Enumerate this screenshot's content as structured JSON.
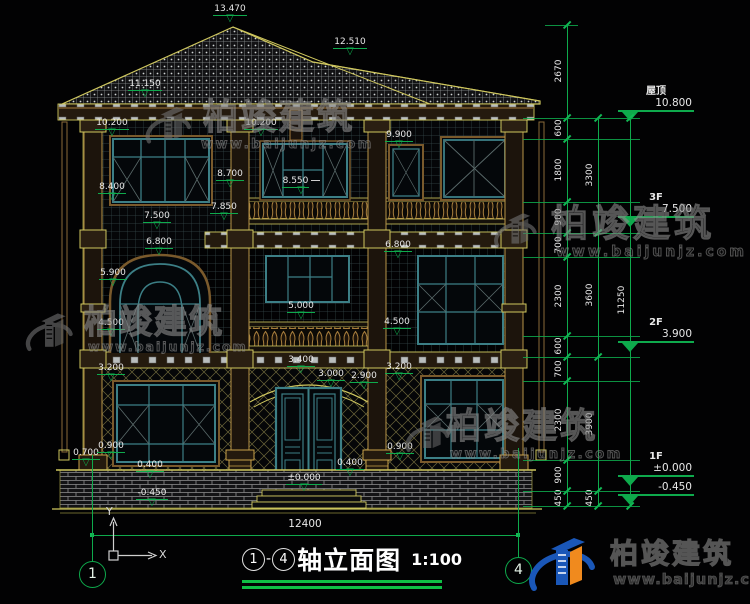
{
  "title_bar": {
    "axis_from": "1",
    "separator": "-",
    "axis_to": "4",
    "title": "轴立面图",
    "scale": "1:100"
  },
  "branding": {
    "brand": "柏竣建筑",
    "url": "www.baijunjz.com"
  },
  "watermark": {
    "brand": "柏竣建筑",
    "url": "www.baijunjz.com"
  },
  "ucs": {
    "x_label": "X",
    "y_label": "Y"
  },
  "overall_dim": {
    "label": "12400",
    "y": 535,
    "x1": 92,
    "x2": 518,
    "label_x": 275,
    "label_y": 518
  },
  "axis_bubbles": [
    {
      "num": "1",
      "cx": 92,
      "cy": 574,
      "stem_top": 455
    },
    {
      "num": "4",
      "cx": 518,
      "cy": 570,
      "stem_top": 448
    }
  ],
  "elevation_flags": [
    {
      "t": "13.470",
      "cx": 230,
      "y": 4
    },
    {
      "t": "12.510",
      "cx": 350,
      "y": 37
    },
    {
      "t": "11.150",
      "cx": 145,
      "y": 79
    },
    {
      "t": "10.200",
      "cx": 112,
      "y": 118
    },
    {
      "t": "10.200",
      "cx": 261,
      "y": 118
    },
    {
      "t": "9.900",
      "cx": 399,
      "y": 130
    },
    {
      "t": "8.700",
      "cx": 230,
      "y": 169
    },
    {
      "t": "8.550",
      "cx": 301,
      "y": 176,
      "dash": true
    },
    {
      "t": "8.400",
      "cx": 112,
      "y": 182
    },
    {
      "t": "7.850",
      "cx": 224,
      "y": 202
    },
    {
      "t": "7.500",
      "cx": 157,
      "y": 211
    },
    {
      "t": "6.800",
      "cx": 159,
      "y": 237
    },
    {
      "t": "6.800",
      "cx": 398,
      "y": 240
    },
    {
      "t": "5.900",
      "cx": 113,
      "y": 268
    },
    {
      "t": "5.000",
      "cx": 301,
      "y": 301
    },
    {
      "t": "4.500",
      "cx": 111,
      "y": 318
    },
    {
      "t": "4.500",
      "cx": 397,
      "y": 317
    },
    {
      "t": "3.400",
      "cx": 301,
      "y": 355
    },
    {
      "t": "3.200",
      "cx": 111,
      "y": 363
    },
    {
      "t": "3.200",
      "cx": 399,
      "y": 362
    },
    {
      "t": "3.000",
      "cx": 331,
      "y": 369
    },
    {
      "t": "2.900",
      "cx": 364,
      "y": 371
    },
    {
      "t": "0.700",
      "cx": 86,
      "y": 448
    },
    {
      "t": "0.900",
      "cx": 111,
      "y": 441
    },
    {
      "t": "0.900",
      "cx": 400,
      "y": 442
    },
    {
      "t": "0.400",
      "cx": 150,
      "y": 460
    },
    {
      "t": "0.400",
      "cx": 350,
      "y": 458
    },
    {
      "t": "±0.000",
      "cx": 304,
      "y": 473
    },
    {
      "t": "-0.450",
      "cx": 152,
      "y": 488
    }
  ],
  "level_markers": [
    {
      "name": "屋顶",
      "val": "10.800",
      "line_y": 112
    },
    {
      "name": "3F",
      "val": "7.500",
      "line_y": 222
    },
    {
      "name": "2F",
      "val": "3.900",
      "line_y": 347
    },
    {
      "name": "1F",
      "val": "±0.000",
      "line_y": 481
    },
    {
      "name": "",
      "val": "-0.450",
      "line_y": 496
    }
  ],
  "dim_chains": [
    {
      "x": 567,
      "ticks": [
        25,
        118,
        139,
        202,
        233,
        257,
        336,
        357,
        381,
        460,
        491,
        506
      ],
      "labels": [
        {
          "t": "2670",
          "y": 71
        },
        {
          "t": "600",
          "y": 128
        },
        {
          "t": "1800",
          "y": 170
        },
        {
          "t": "900",
          "y": 217
        },
        {
          "t": "700",
          "y": 245
        },
        {
          "t": "2300",
          "y": 296
        },
        {
          "t": "600",
          "y": 346
        },
        {
          "t": "700",
          "y": 369
        },
        {
          "t": "2300",
          "y": 420
        },
        {
          "t": "900",
          "y": 475
        },
        {
          "t": "450",
          "y": 498
        }
      ]
    },
    {
      "x": 598,
      "ticks": [
        118,
        233,
        357,
        491,
        506
      ],
      "labels": [
        {
          "t": "3300",
          "y": 175
        },
        {
          "t": "3600",
          "y": 295
        },
        {
          "t": "3900",
          "y": 424
        },
        {
          "t": "450",
          "y": 498
        }
      ]
    },
    {
      "x": 630,
      "ticks": [
        118,
        506
      ],
      "labels": [
        {
          "t": "11250",
          "y": 300
        }
      ]
    }
  ],
  "extension_lines": [
    118,
    139,
    202,
    233,
    257,
    336,
    357,
    381,
    460,
    491,
    506
  ],
  "colors": {
    "dim_green": "#0eaa4c",
    "cad_yellow": "#cfc75e",
    "frame_teal": "#3c7f86",
    "text_white": "#e8e8e8",
    "logo_blue": "#1a57b8",
    "logo_orange": "#f08a1e"
  }
}
